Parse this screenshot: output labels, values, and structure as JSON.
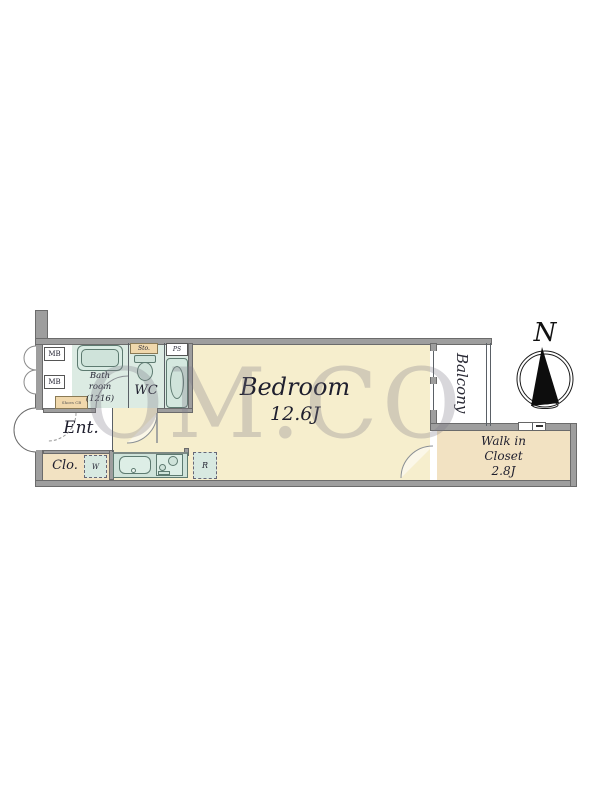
{
  "colors": {
    "floor_main": "#f6eecd",
    "floor_tan": "#f2e2c2",
    "floor_wet": "#dcebe3",
    "fixture_green": "#cfe3da",
    "storage_tan": "#f0d8ac",
    "wall_gray": "#9e9e9e",
    "watermark_gray": "#7d7b88"
  },
  "watermark": "OM.CO",
  "compass": {
    "north_label": "N"
  },
  "rooms": {
    "bedroom": {
      "name": "Bedroom",
      "size": "12.6J"
    },
    "balcony": {
      "name": "Balcony"
    },
    "walk_in_closet": {
      "line1": "Walk in",
      "line2": "Closet",
      "size": "2.8J"
    },
    "entrance": {
      "name": "Ent."
    },
    "closet": {
      "name": "Clo."
    },
    "bathroom": {
      "line1": "Bath",
      "line2": "room",
      "line3": "(1216)"
    },
    "wc": {
      "name": "WC"
    }
  },
  "fixtures": {
    "meter_box_1": "MB",
    "meter_box_2": "MB",
    "storage": "Sto.",
    "pipe_space": "PS",
    "washer": "W",
    "refrigerator": "R",
    "shoe_cabinet": "Shoes CB"
  }
}
